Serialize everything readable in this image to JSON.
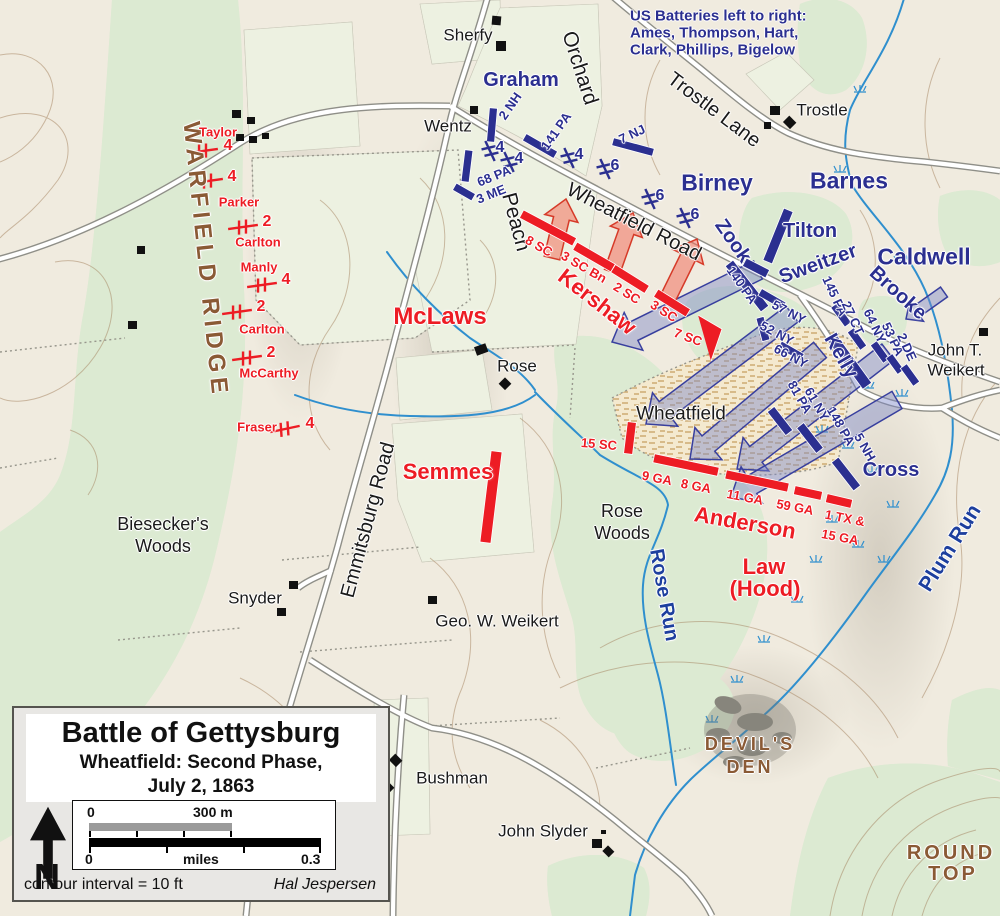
{
  "map_note": {
    "l1": "US Batteries left to right:",
    "l2": "Ames, Thompson, Hart,",
    "l3": "Clark, Phillips, Bigelow"
  },
  "places": {
    "sherfy": "Sherfy",
    "wentz": "Wentz",
    "trostle": "Trostle",
    "rose": "Rose",
    "snyder": "Snyder",
    "geo_weikert": "Geo. W. Weikert",
    "bushman": "Bushman",
    "john_slyder": "John Slyder",
    "jtw_1": "John T.",
    "jtw_2": "Weikert",
    "biesecker_1": "Biesecker's",
    "biesecker_2": "Woods",
    "rosewoods_1": "Rose",
    "rosewoods_2": "Woods",
    "wheatfield": "Wheatfield"
  },
  "roads": {
    "emmitsburg": "Emmitsburg Road",
    "wheatfield_road": "Wheatfield Road",
    "trostle_lane": "Trostle Lane",
    "peach": "Peach",
    "orchard": "Orchard"
  },
  "terrain": {
    "warfield_ridge": "WARFIELD RIDGE",
    "devils_den_1": "DEVIL'S",
    "devils_den_2": "DEN",
    "round_top_1": "ROUND",
    "round_top_2": "TOP"
  },
  "water": {
    "plum_run": "Plum Run",
    "rose_run": "Rose Run"
  },
  "union": {
    "commands": {
      "graham": "Graham",
      "birney": "Birney",
      "barnes": "Barnes",
      "tilton": "Tilton",
      "sweitzer": "Sweitzer",
      "caldwell": "Caldwell",
      "brooke": "Brooke",
      "zook": "Zook",
      "kelly": "Kelly",
      "cross": "Cross"
    },
    "regiments": {
      "nh2": "2 NH",
      "pa141": "141 PA",
      "nj7": "7 NJ",
      "pa68": "68 PA",
      "me3": "3 ME",
      "pa140": "140 PA",
      "ny57": "57 NY",
      "ny52": "52 NY",
      "ny66": "66 NY",
      "pa145": "145 PA",
      "ct27": "27 CT",
      "ny64": "64 NY",
      "pa53": "53 PA",
      "de2": "2 DE",
      "pa81": "81 PA",
      "ny61": "61 NY",
      "pa148": "148 PA",
      "nh5": "5 NH"
    },
    "battery_counts": [
      "4",
      "4",
      "4",
      "6",
      "6",
      "6"
    ]
  },
  "confederate": {
    "commands": {
      "mclaws": "McLaws",
      "kershaw": "Kershaw",
      "semmes": "Semmes",
      "anderson": "Anderson",
      "law_1": "Law",
      "law_2": "(Hood)"
    },
    "batteries": {
      "taylor": "Taylor",
      "parker": "Parker",
      "carlton_1": "Carlton",
      "manly": "Manly",
      "carlton_2": "Carlton",
      "mccarthy": "McCarthy",
      "fraser": "Fraser"
    },
    "battery_counts": [
      "4",
      "4",
      "2",
      "4",
      "2",
      "2",
      "4"
    ],
    "regiments": {
      "sc8": "8 SC",
      "sc3bn": "3 SC Bn",
      "sc2": "2 SC",
      "sc3": "3 SC",
      "sc7": "7 SC",
      "sc15": "15 SC",
      "ga9": "9 GA",
      "ga8": "8 GA",
      "ga11": "11 GA",
      "ga59": "59 GA",
      "tx1": "1 TX &",
      "ga15": "15 GA"
    }
  },
  "legend": {
    "title": "Battle of Gettysburg",
    "subtitle_1": "Wheatfield: Second Phase,",
    "subtitle_2": "July 2, 1863",
    "north": "N",
    "scale_m_zero": "0",
    "scale_m_max": "300 m",
    "scale_mi_zero": "0",
    "scale_mi_unit": "miles",
    "scale_mi_max": "0.3",
    "contour_note": "contour interval = 10 ft",
    "author": "Hal Jespersen"
  },
  "colors": {
    "union": "#2b2f90",
    "confederate": "#ed1c24",
    "terrain_label": "#8a5a35",
    "water": "#1d3f9e",
    "background": "#f0ebdf",
    "woods": "#dcead2",
    "orchard_dot": "#16a058",
    "stream": "#2f8fce",
    "road": "#ffffff"
  }
}
